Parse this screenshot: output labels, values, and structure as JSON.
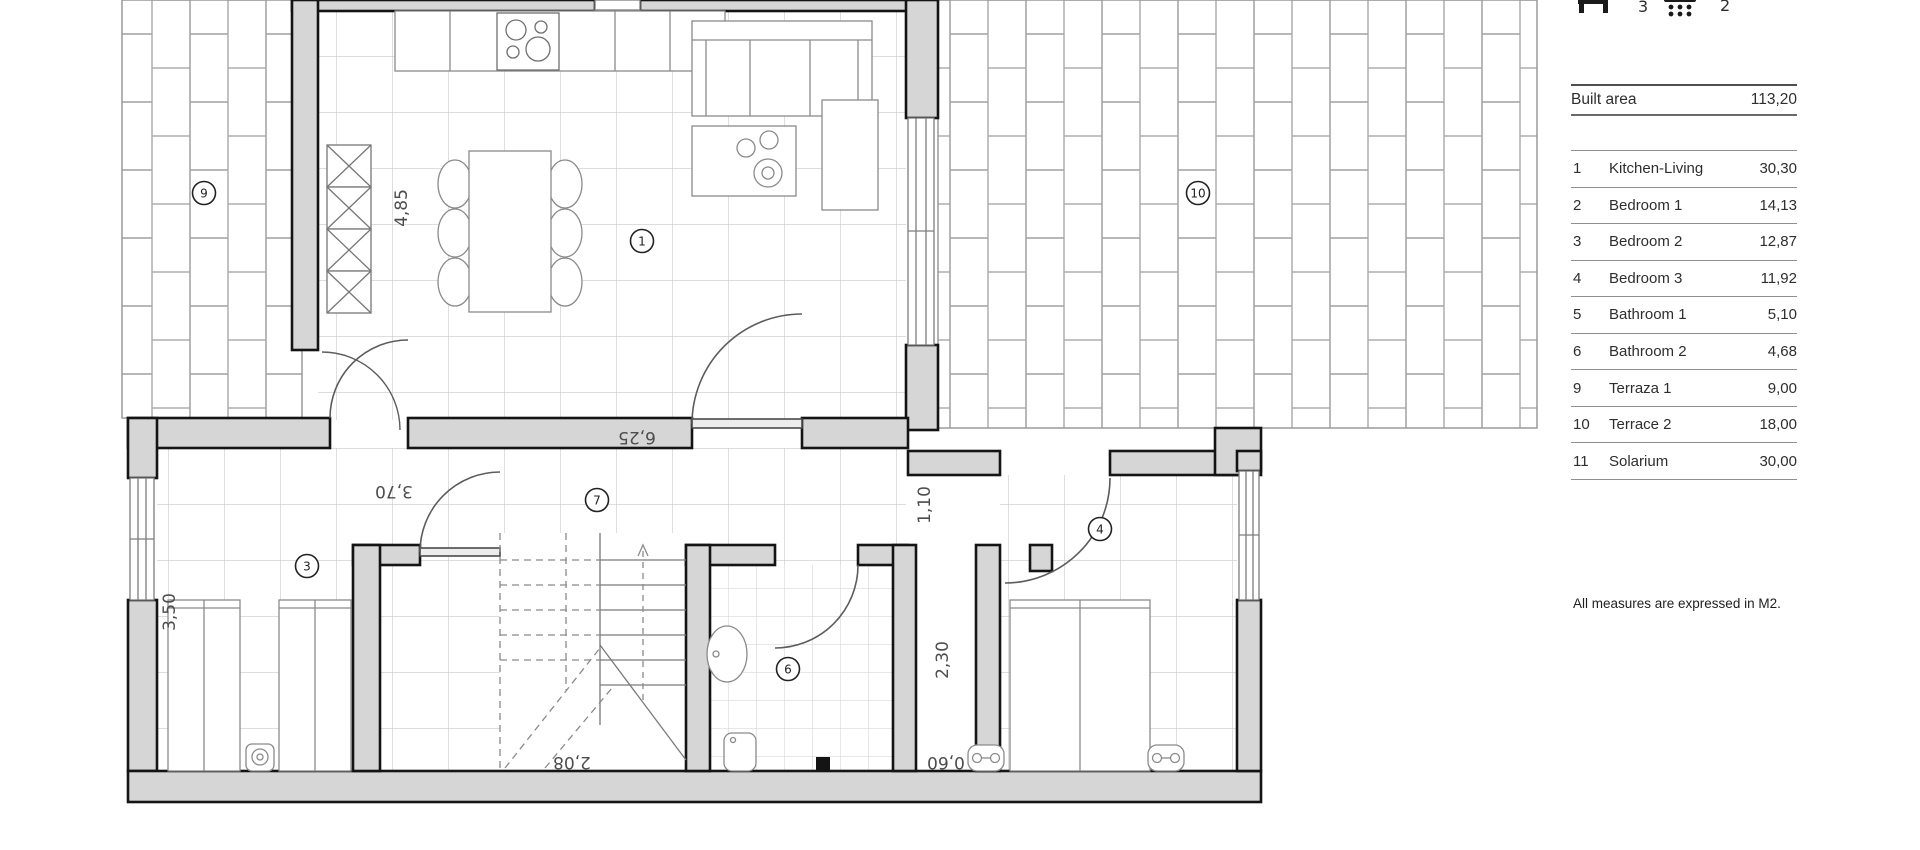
{
  "header_icons": {
    "bedrooms_count": "3",
    "bathrooms_count": "2"
  },
  "area_table": {
    "built_area_label": "Built area",
    "built_area_value": "113,20",
    "rows": [
      {
        "num": "1",
        "name": "Kitchen-Living",
        "area": "30,30"
      },
      {
        "num": "2",
        "name": "Bedroom 1",
        "area": "14,13"
      },
      {
        "num": "3",
        "name": "Bedroom 2",
        "area": "12,87"
      },
      {
        "num": "4",
        "name": "Bedroom 3",
        "area": "11,92"
      },
      {
        "num": "5",
        "name": "Bathroom 1",
        "area": "5,10"
      },
      {
        "num": "6",
        "name": "Bathroom 2",
        "area": "4,68"
      },
      {
        "num": "9",
        "name": "Terraza 1",
        "area": "9,00"
      },
      {
        "num": "10",
        "name": "Terrace 2",
        "area": "18,00"
      },
      {
        "num": "11",
        "name": "Solarium",
        "area": "30,00"
      }
    ],
    "note": "All measures are expressed in M2."
  },
  "plan": {
    "room_markers": {
      "kitchen_living": "1",
      "bedroom_2": "3",
      "bedroom_3": "4",
      "bathroom_2": "6",
      "hall": "7",
      "terrace_1": "9",
      "terrace_2": "10"
    },
    "dimensions": {
      "kitchen_depth": "4,85",
      "kitchen_width": "6,25",
      "bedroom2_width": "3,70",
      "bedroom2_depth": "3,50",
      "bedroom3_door": "1,10",
      "shaft_depth": "2,30",
      "shaft_width": "0,60",
      "stairs_width": "2,08"
    }
  },
  "colors": {
    "wall_fill": "#d6d6d6",
    "wall_line": "#141414",
    "dim_text": "#4d4d4d"
  }
}
